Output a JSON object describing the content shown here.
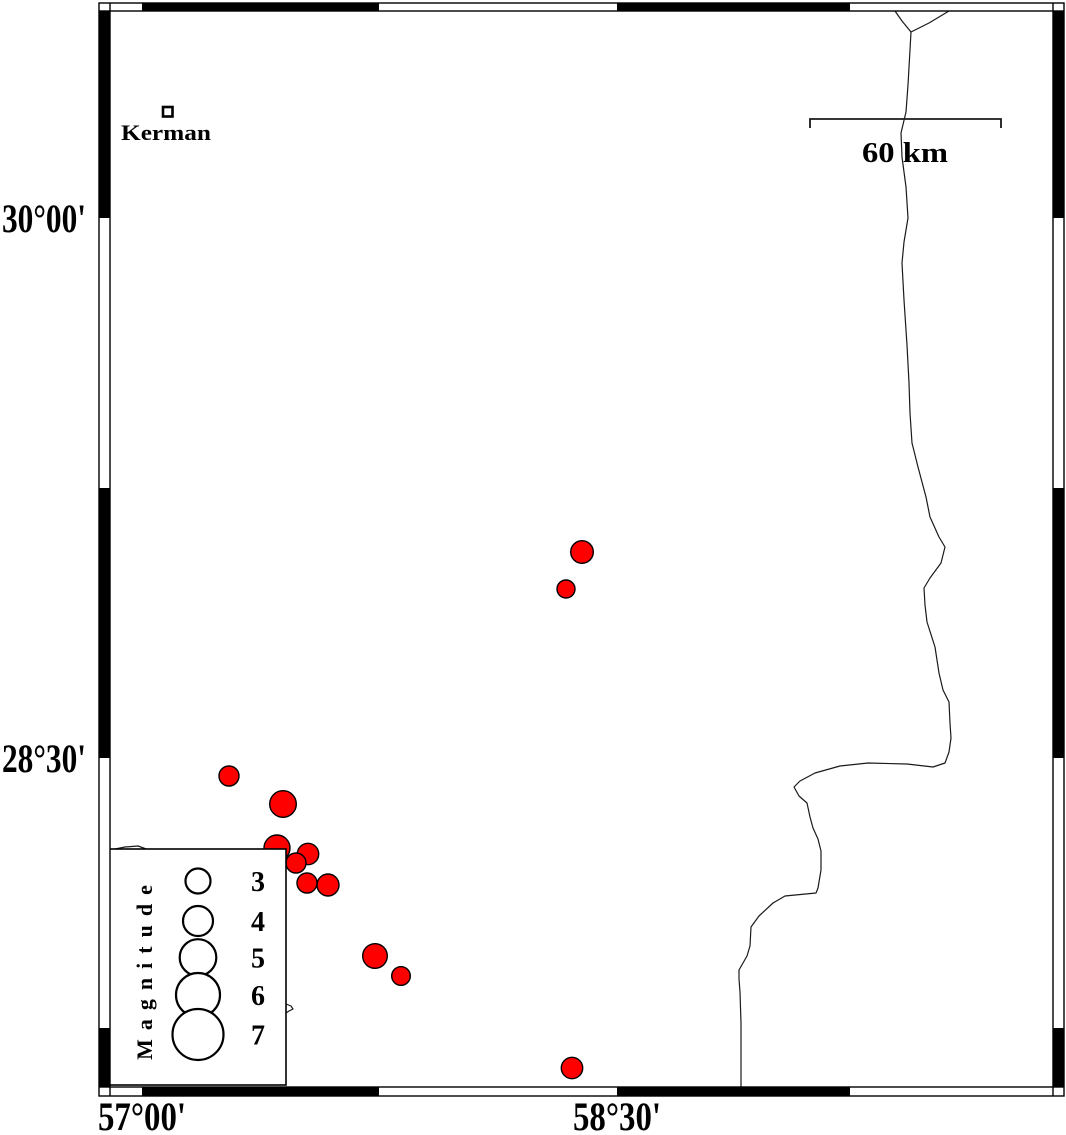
{
  "map": {
    "place": {
      "label": "Kerman"
    },
    "scale_bar": {
      "label": "60 km"
    },
    "axis": {
      "left": [
        {
          "text": "30°00'"
        },
        {
          "text": "28°30'"
        }
      ],
      "bottom": [
        {
          "text": "57°00'"
        },
        {
          "text": "58°30'"
        }
      ]
    },
    "legend": {
      "title": "Magnitude"
    },
    "colors": {
      "earthquake_fill": "#ff0000",
      "frame": "#000000",
      "road": "#1a1a1a",
      "background": "#ffffff"
    }
  },
  "chart_data": {
    "type": "map",
    "description": "Seismicity map of the Kerman region, Iran. Red circles are earthquake epicenters sized by magnitude; GMT-style fancy frame with alternating black/white 45-arcminute segments; latitude labels 30°00' and 28°30'; longitude labels 57°00' and 58°30'; 60 km scale bar; town marker for Kerman; thin road/boundary lines in the east.",
    "earthquakes": [
      {
        "x": 582,
        "y": 552,
        "r": 11.3
      },
      {
        "x": 566,
        "y": 589,
        "r": 9.0
      },
      {
        "x": 229,
        "y": 776,
        "r": 10.0
      },
      {
        "x": 283,
        "y": 804,
        "r": 13.3
      },
      {
        "x": 277,
        "y": 848,
        "r": 13.0
      },
      {
        "x": 308,
        "y": 854,
        "r": 10.7
      },
      {
        "x": 296,
        "y": 863,
        "r": 10.0
      },
      {
        "x": 307,
        "y": 883,
        "r": 10.0
      },
      {
        "x": 328,
        "y": 885,
        "r": 11.0
      },
      {
        "x": 375,
        "y": 956,
        "r": 12.3
      },
      {
        "x": 401,
        "y": 976,
        "r": 9.3
      },
      {
        "x": 572,
        "y": 1068,
        "r": 10.7
      }
    ],
    "legend": {
      "circle_cx": 198,
      "label_x": 258,
      "box": [
        109,
        849,
        177,
        236
      ],
      "entries": [
        {
          "label": "3",
          "cy": 881,
          "r": 12.5
        },
        {
          "label": "4",
          "cy": 921,
          "r": 15.0
        },
        {
          "label": "5",
          "cy": 957.5,
          "r": 18.3
        },
        {
          "label": "6",
          "cy": 995,
          "r": 22.0
        },
        {
          "label": "7",
          "cy": 1034.5,
          "r": 25.5
        }
      ]
    },
    "scale_bar": {
      "x1": 810,
      "x2": 1001,
      "y": 119,
      "tick": 9
    },
    "roads": [
      {
        "name": "road-branch-left",
        "points": "895,11 902,21 911,32"
      },
      {
        "name": "road-branch-right",
        "points": "949,11 929,23 911,32"
      },
      {
        "name": "road-main",
        "points": "911,32 908,85 906,112 901,133 902,157 906,187 908,218 904,242 902,263 904,300 907,345 909,383 910,413 912,443 918,467 926,497 930,517 939,537 945,547 941,563 930,578 924,588 925,605 927,622 935,647 939,673 943,690 949,702 950,723 951,738 949,752 945,763 933,767 907,764 868,763 840,766 815,773 800,781 794,787 799,796 807,803 810,817 813,828 818,839 821,851 821,870 818,888 816,893 785,896 773,903 759,916 751,927 750,946 747,956 739,970 739,979 740,992 741,1023 741,1087"
      },
      {
        "name": "road-fragment-legend-top",
        "points": "110,850 125,847 138,846 149,850"
      },
      {
        "name": "road-fragment-legend-right",
        "points": "286,1004 291,1006 293,1009 289,1011 286,1013"
      }
    ],
    "frame": {
      "outer": [
        99,
        3,
        1064,
        1096
      ],
      "inner": [
        110,
        11,
        1053,
        1087
      ],
      "x_black": [
        [
          142,
          379
        ],
        [
          617,
          850
        ]
      ],
      "y_black": [
        [
          11,
          218
        ],
        [
          488,
          758
        ],
        [
          1028,
          1087
        ]
      ]
    }
  }
}
